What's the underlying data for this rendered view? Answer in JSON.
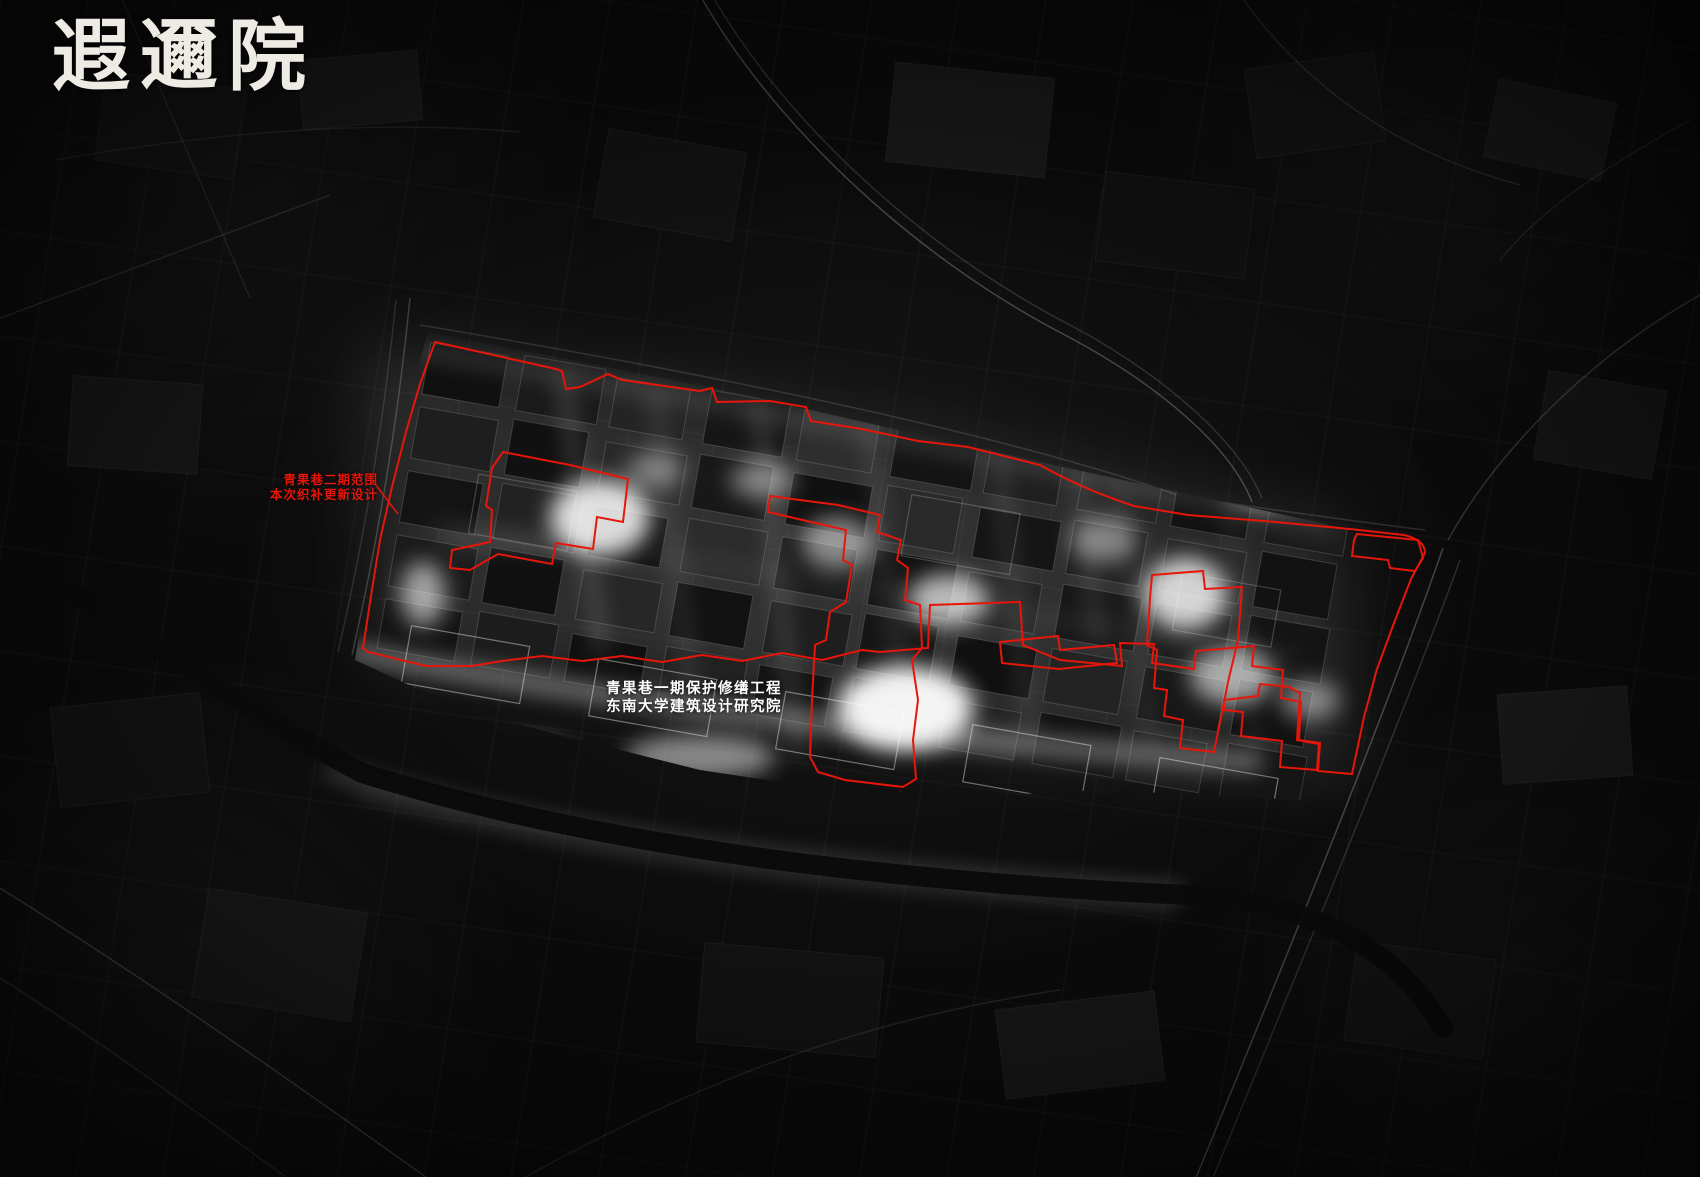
{
  "poster": {
    "title": "遐邇院",
    "labels": {
      "phase2_scope": {
        "line1": "青果巷二期范围",
        "line2": "本次织补更新设计"
      },
      "phase1_project": {
        "line1": "青果巷一期保护修缮工程",
        "line2": "东南大学建筑设计研究院"
      }
    },
    "colors": {
      "background": "#0a0a0a",
      "boundary_red": "#e8150a",
      "label_white": "#ffffff",
      "title_white": "#edebe4"
    }
  }
}
